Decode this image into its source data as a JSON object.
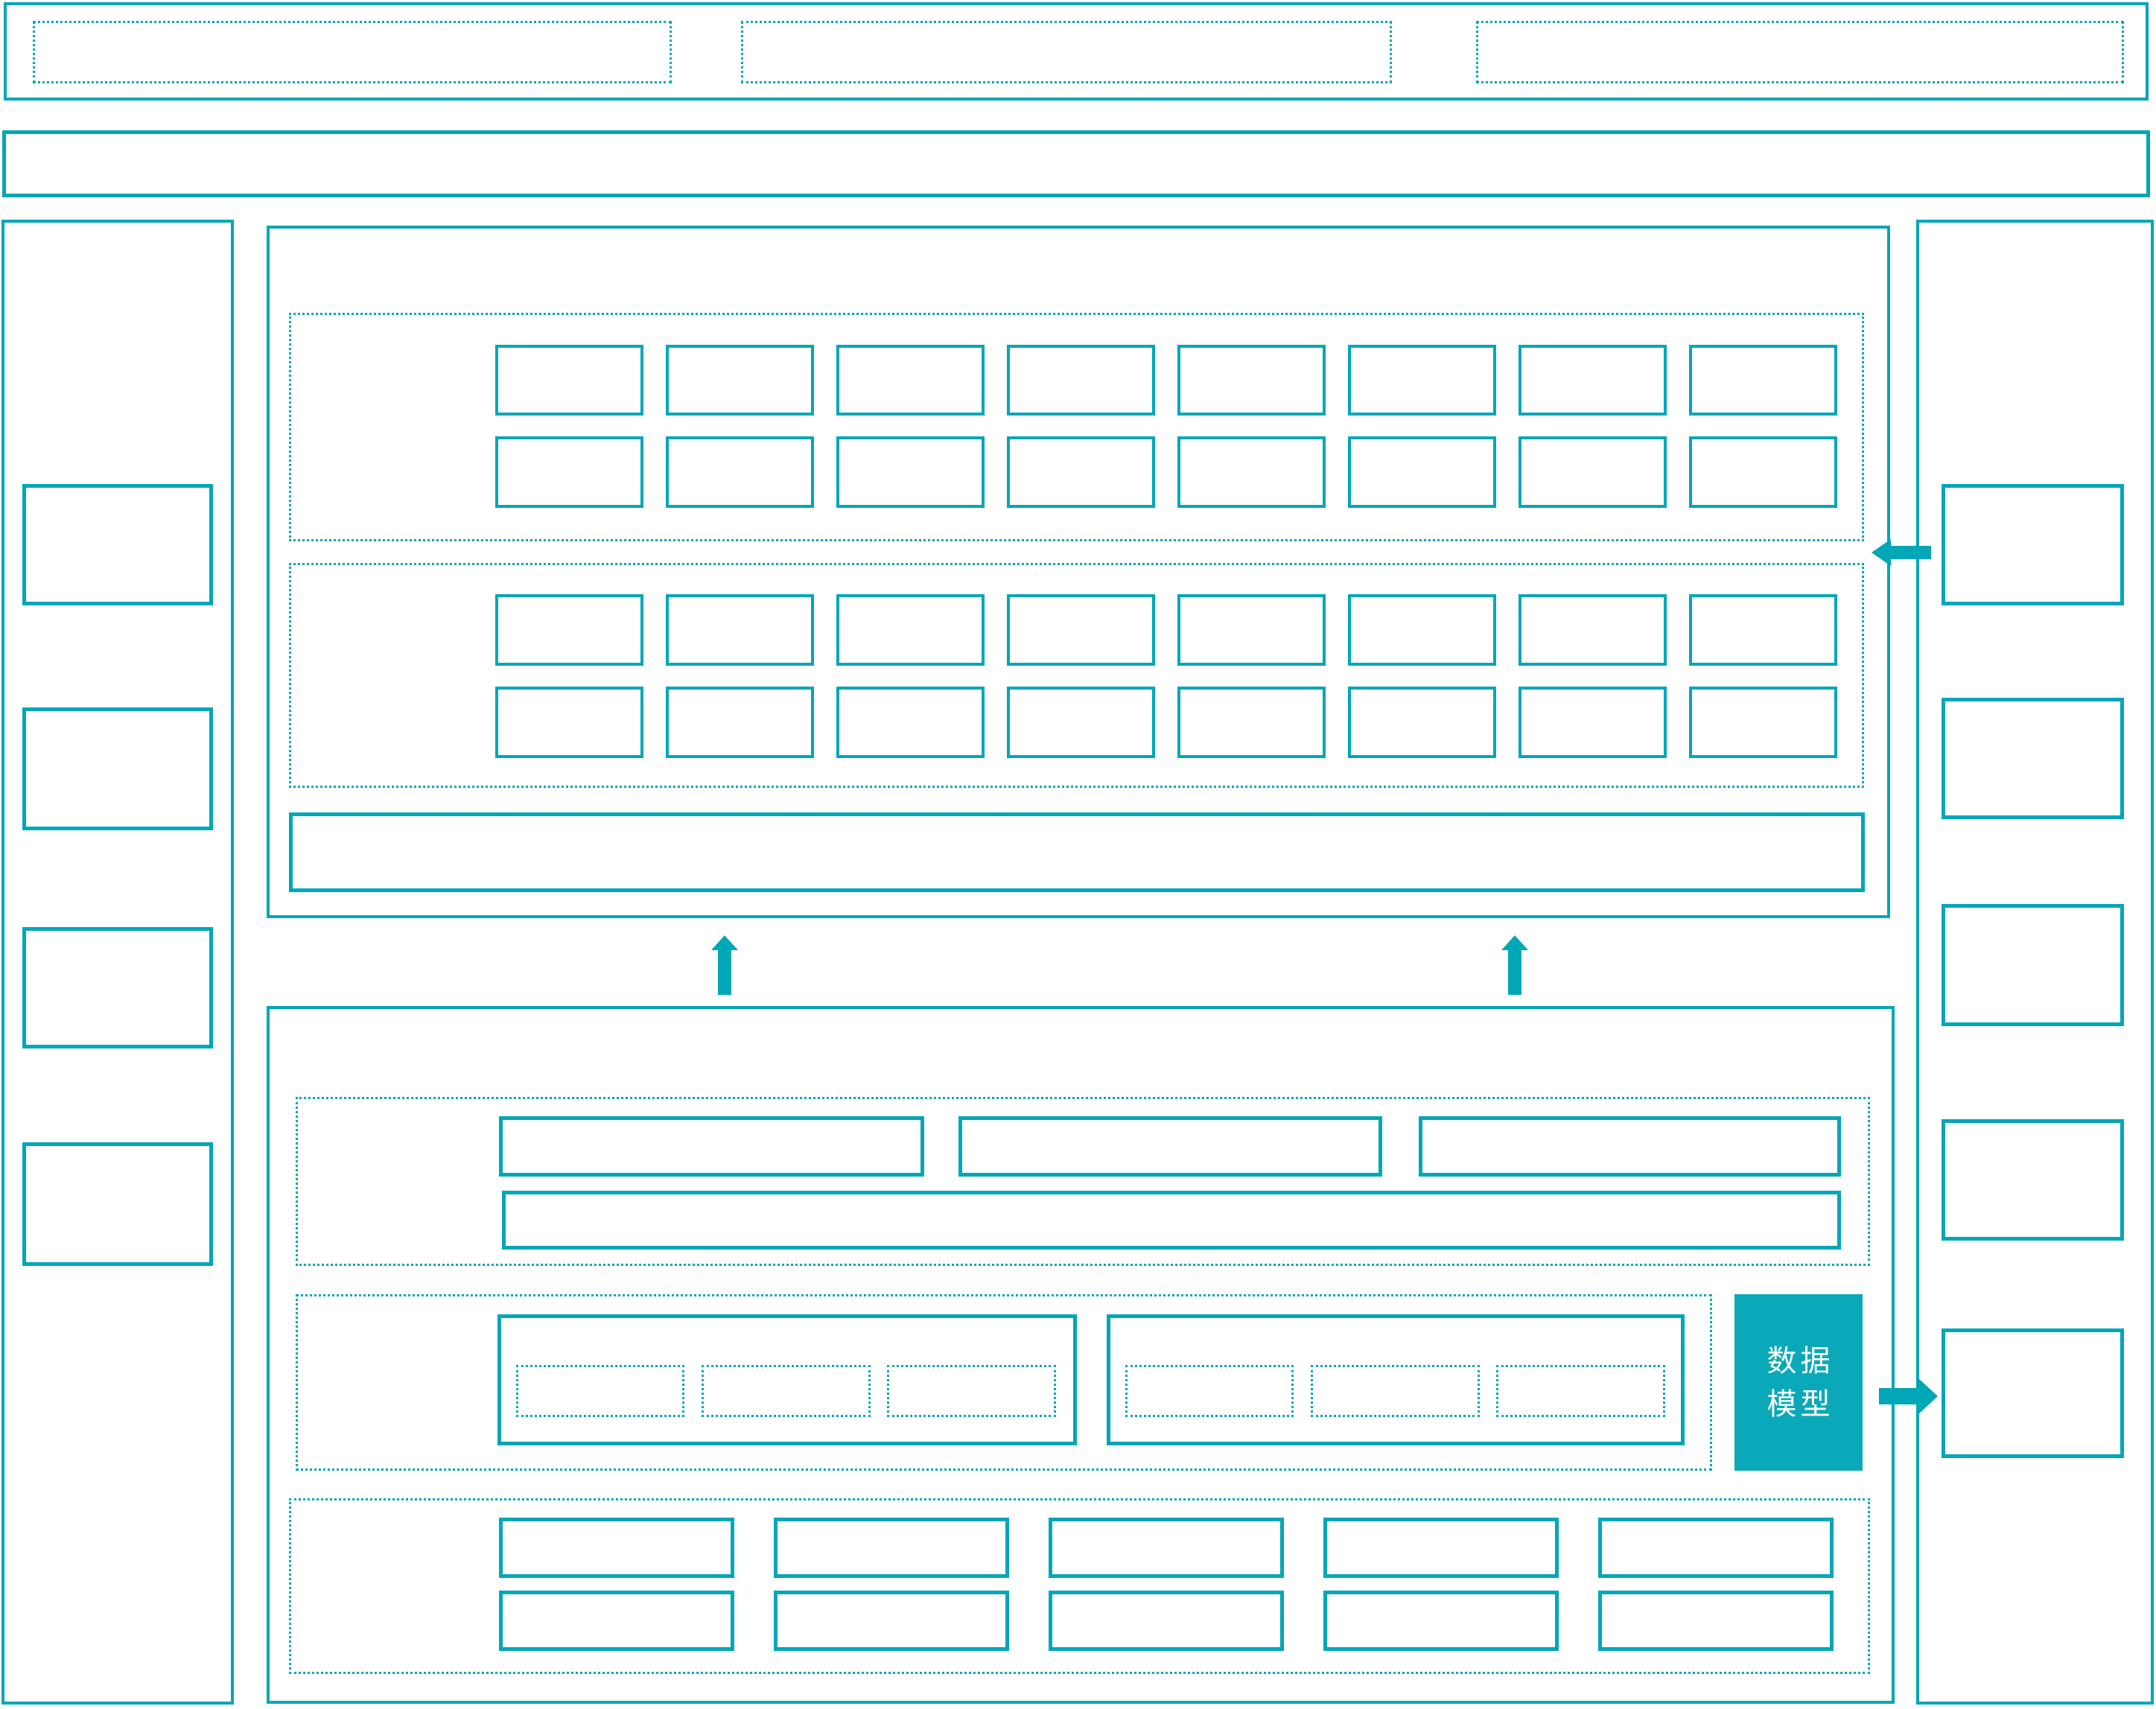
{
  "colors": {
    "accent": "#00a7b7",
    "data_model_fill": "#0aa9b9",
    "text_on_fill": "#ffffff",
    "background": "#ffffff"
  },
  "data_model": {
    "line1": "数据",
    "line2": "模型"
  },
  "icons": {
    "up_arrow": "css-triangle-up",
    "left_arrow": "css-triangle-left",
    "right_arrow": "css-triangle-right"
  }
}
